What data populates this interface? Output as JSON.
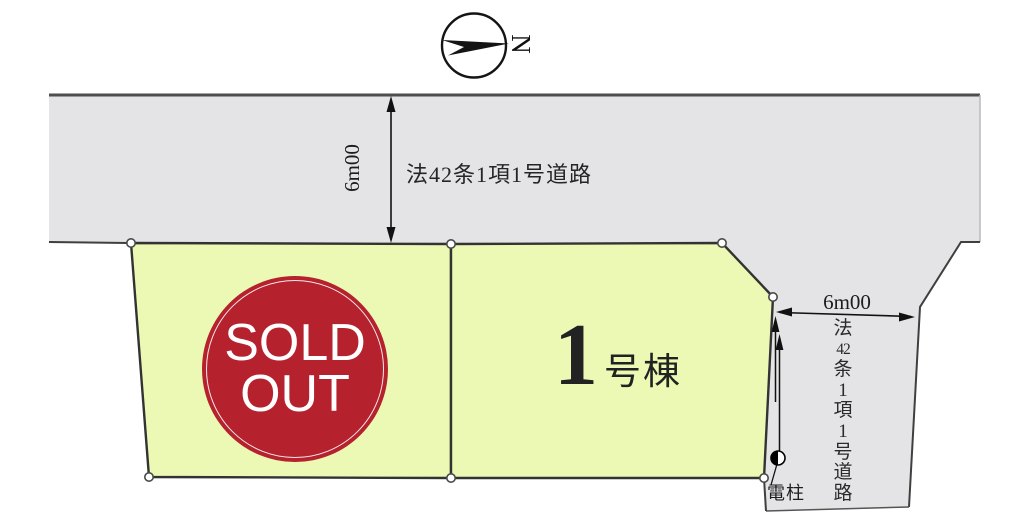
{
  "compass": {
    "label": "N"
  },
  "top_road": {
    "name": "法42条1項1号道路",
    "width_dim": "6m00"
  },
  "side_road": {
    "width_dim": "6m00",
    "label_chars": [
      "法",
      "42",
      "条",
      "1",
      "項",
      "1",
      "号",
      "道",
      "路"
    ]
  },
  "lots": {
    "sold": {
      "line1": "SOLD",
      "line2": "OUT"
    },
    "lot1": {
      "number": "1",
      "suffix": "号棟"
    }
  },
  "pole": {
    "label": "電柱"
  },
  "colors": {
    "road_fill": "#e4e4e6",
    "lot_fill": "#ebf9b5",
    "sold_red": "#b5212d",
    "line_dark": "#3c3c3c",
    "ink": "#111111"
  }
}
